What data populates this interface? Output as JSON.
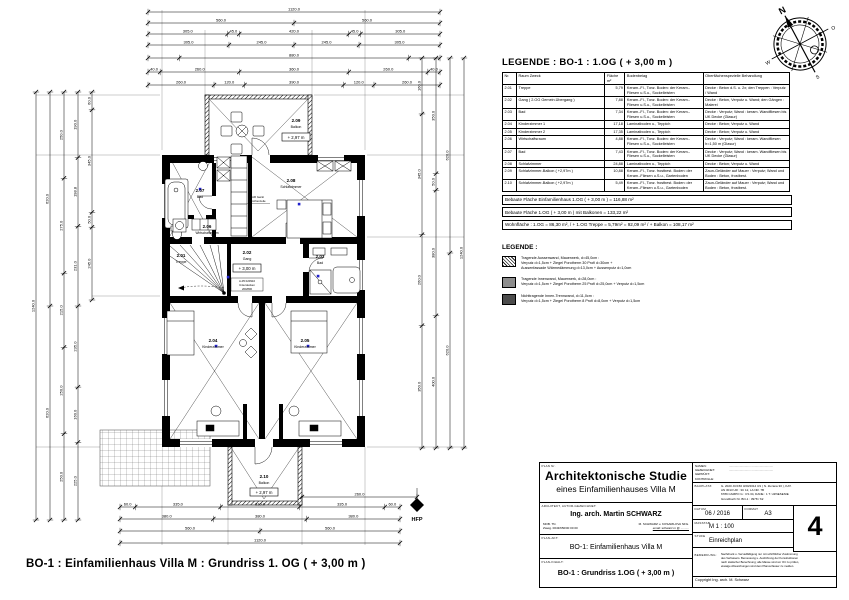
{
  "plan": {
    "caption": "BO-1 : Einfamilienhaus Villa M : Grundriss 1. OG ( + 3,00 m )",
    "hfp": "HFP",
    "levels": {
      "og": "+ 3,00 m",
      "balkon_top": "+ 2,97 m",
      "balkon_bottom": "+ 2,97 m"
    },
    "note_gang": [
      "A-05 020910",
      "Unterdecken",
      "200/800"
    ],
    "note_schlaf1": "AR Gerät",
    "note_schlaf2": "Küchenzeile",
    "rooms": [
      {
        "nr": "2.01",
        "name": "Treppe"
      },
      {
        "nr": "2.02",
        "name": "Gang"
      },
      {
        "nr": "2.03",
        "name": "Bad"
      },
      {
        "nr": "2.04",
        "name": "Kinderzimmer"
      },
      {
        "nr": "2.05",
        "name": "Kinderzimmer"
      },
      {
        "nr": "2.06",
        "name": "Wirtschaftsraum"
      },
      {
        "nr": "2.07",
        "name": "Bad"
      },
      {
        "nr": "2.08",
        "name": "Schlafzimmer"
      },
      {
        "nr": "2.09",
        "name": "Balkon"
      },
      {
        "nr": "2.10",
        "name": "Balkon"
      }
    ],
    "accent_blue": "#2020cc",
    "dim_chains": [
      {
        "o": "h",
        "y": 12,
        "x1": 148,
        "x2": 440,
        "segs": [
          {
            "w": 1120,
            "t": "1120.0"
          }
        ]
      },
      {
        "o": "h",
        "y": 23,
        "x1": 148,
        "x2": 440,
        "segs": [
          {
            "w": 560,
            "t": "560.0"
          },
          {
            "w": 560,
            "t": "560.0"
          }
        ]
      },
      {
        "o": "h",
        "y": 34,
        "x1": 148,
        "x2": 440,
        "segs": [
          {
            "w": 305,
            "t": "305.0"
          },
          {
            "w": 45,
            "t": "45.0"
          },
          {
            "w": 420,
            "t": "420.0"
          },
          {
            "w": 45,
            "t": "45.0"
          },
          {
            "w": 305,
            "t": "305.0"
          }
        ]
      },
      {
        "o": "h",
        "y": 45,
        "x1": 148,
        "x2": 440,
        "segs": [
          {
            "w": 305,
            "t": "305.0"
          },
          {
            "w": 245,
            "t": "245.0"
          },
          {
            "w": 245,
            "t": "245.0"
          },
          {
            "w": 305,
            "t": "305.0"
          }
        ]
      },
      {
        "o": "h",
        "y": 58,
        "x1": 148,
        "x2": 440,
        "segs": [
          {
            "w": 120,
            "t": ""
          },
          {
            "w": 880,
            "t": "880.0"
          },
          {
            "w": 120,
            "t": ""
          }
        ]
      },
      {
        "o": "h",
        "y": 72,
        "x1": 148,
        "x2": 440,
        "segs": [
          {
            "w": 40,
            "t": "40.0"
          },
          {
            "w": 260,
            "t": "260.0"
          },
          {
            "w": 360,
            "t": "360.0"
          },
          {
            "w": 260,
            "t": "260.0"
          },
          {
            "w": 40,
            "t": "40.0"
          }
        ]
      },
      {
        "o": "h",
        "y": 85,
        "x1": 148,
        "x2": 440,
        "segs": [
          {
            "w": 260,
            "t": "260.0"
          },
          {
            "w": 120,
            "t": "120.0"
          },
          {
            "w": 390,
            "t": "390.0"
          },
          {
            "w": 120,
            "t": "120.0"
          },
          {
            "w": 260,
            "t": "260.0"
          }
        ]
      },
      {
        "o": "h",
        "y": 497,
        "x1": 302,
        "x2": 417,
        "segs": [
          {
            "w": 260,
            "t": "260.0"
          }
        ]
      },
      {
        "o": "h",
        "y": 507,
        "x1": 120,
        "x2": 400,
        "segs": [
          {
            "w": 60,
            "t": "60.0"
          },
          {
            "w": 335,
            "t": "335.0"
          },
          {
            "w": 310,
            "t": "310.0"
          },
          {
            "w": 335,
            "t": "335.0"
          },
          {
            "w": 60,
            "t": "60.0"
          }
        ]
      },
      {
        "o": "h",
        "y": 519,
        "x1": 120,
        "x2": 400,
        "segs": [
          {
            "w": 380,
            "t": "380.0"
          },
          {
            "w": 380,
            "t": "380.0"
          },
          {
            "w": 380,
            "t": "380.0"
          }
        ]
      },
      {
        "o": "h",
        "y": 531,
        "x1": 120,
        "x2": 400,
        "segs": [
          {
            "w": 560,
            "t": "560.0"
          },
          {
            "w": 560,
            "t": "560.0"
          }
        ]
      },
      {
        "o": "h",
        "y": 543,
        "x1": 120,
        "x2": 400,
        "segs": [
          {
            "w": 1120,
            "t": "1120.0"
          }
        ]
      },
      {
        "o": "v",
        "x": 36,
        "y1": 92,
        "y2": 520,
        "segs": [
          {
            "w": 1240,
            "t": "1240.0"
          }
        ]
      },
      {
        "o": "v",
        "x": 50,
        "y1": 92,
        "y2": 520,
        "segs": [
          {
            "w": 620,
            "t": "620.0"
          },
          {
            "w": 620,
            "t": "620.0"
          }
        ]
      },
      {
        "o": "v",
        "x": 64,
        "y1": 92,
        "y2": 520,
        "segs": [
          {
            "w": 250,
            "t": "250.0"
          },
          {
            "w": 275,
            "t": "275.0"
          },
          {
            "w": 215,
            "t": "215.0"
          },
          {
            "w": 250,
            "t": "250.0"
          },
          {
            "w": 250,
            "t": "250.0"
          }
        ]
      },
      {
        "o": "v",
        "x": 78,
        "y1": 92,
        "y2": 520,
        "segs": [
          {
            "w": 190,
            "t": "190.0"
          },
          {
            "w": 199,
            "t": "198.8"
          },
          {
            "w": 231,
            "t": "231.0"
          },
          {
            "w": 235,
            "t": "235.0"
          },
          {
            "w": 160,
            "t": "160.0"
          },
          {
            "w": 225,
            "t": "225.0"
          }
        ]
      },
      {
        "o": "v",
        "x": 92,
        "y1": 92,
        "y2": 300,
        "segs": [
          {
            "w": 60,
            "t": "60.0"
          },
          {
            "w": 345,
            "t": "345.0"
          },
          {
            "w": 50,
            "t": "50.0"
          },
          {
            "w": 245,
            "t": "245.0"
          }
        ]
      },
      {
        "o": "v",
        "x": 422,
        "y1": 58,
        "y2": 448,
        "segs": [
          {
            "w": 160,
            "t": "160.0"
          },
          {
            "w": 345,
            "t": "345.0"
          },
          {
            "w": 260,
            "t": "260.0"
          },
          {
            "w": 350,
            "t": "350.0"
          }
        ]
      },
      {
        "o": "v",
        "x": 436,
        "y1": 58,
        "y2": 448,
        "segs": [
          {
            "w": 350,
            "t": "350.0"
          },
          {
            "w": 50,
            "t": "50.0"
          },
          {
            "w": 380,
            "t": "380.0"
          },
          {
            "w": 400,
            "t": "400.0"
          }
        ]
      },
      {
        "o": "v",
        "x": 450,
        "y1": 58,
        "y2": 448,
        "segs": [
          {
            "w": 620,
            "t": "620.0"
          },
          {
            "w": 620,
            "t": "620.0"
          }
        ]
      },
      {
        "o": "v",
        "x": 464,
        "y1": 58,
        "y2": 448,
        "segs": [
          {
            "w": 1240,
            "t": "1240.0"
          }
        ]
      }
    ]
  },
  "compass": {
    "n": "N",
    "e": "O",
    "s": "S",
    "w": "W"
  },
  "legend_table": {
    "title": "LEGENDE : BO-1 : 1.OG ( + 3,00 m )",
    "headers": [
      "Nr.",
      "Raum Zweck",
      "Fläche m²",
      "Bodenbelag",
      "Oberflächenspezielle Behandlung"
    ],
    "rows": [
      {
        "nr": "2.01",
        "name": "Treppe",
        "area": "5,79",
        "floor": "Keram.-Fl., Tonz. Boden: der Keram.-Fliesen u.S.u., Sockelleisten",
        "surface": "Decke : Beton d.S. u. 2x; den Treppen : Verputz / Wand"
      },
      {
        "nr": "2.02",
        "name": "Gang ( 2.OG Gemein.Übergang )",
        "area": "7,88",
        "floor": "Keram.-Fl., Tonz. Boden: der Keram.-Fliesen u.S.u., Sockelleisten",
        "surface": "Decke : Beton, Verputz u. Wand; den Gängen : Malerei"
      },
      {
        "nr": "2.03",
        "name": "Bad",
        "area": "7,34",
        "floor": "Keram.-Fl., Tonz. Boden: der Keram.-Fliesen u.S.u., Sockelleisten",
        "surface": "Decke : Verputz; Wand : keram. Wandfliesen bis UK Decke (Glasur)"
      },
      {
        "nr": "2.04",
        "name": "Kinderzimmer 1",
        "area": "17,18",
        "floor": "Laminatboden u., Teppich",
        "surface": "Decke : Beton; Verputz u. Wand"
      },
      {
        "nr": "2.05",
        "name": "Kinderzimmer 2",
        "area": "17,35",
        "floor": "Laminatboden u., Teppich",
        "surface": "Decke : Beton; Verputz u. Wand"
      },
      {
        "nr": "2.06",
        "name": "Wirtschaftsraum",
        "area": "4,88",
        "floor": "Keram.-Fl., Tonz. Boden: der Keram.-Fliesen u.S.u., Sockelleisten",
        "surface": "Decke : Verputz; Wand : keram. Wandfliesen h=1,50 m (Glasur)"
      },
      {
        "nr": "2.07",
        "name": "Bad",
        "area": "7,43",
        "floor": "Keram.-Fl., Tonz. Boden: der Keram.-Fliesen u.S.u., Sockelleisten",
        "surface": "Decke : Verputz; Wand : keram. Wandfliesen bis UK Decke (Glasur)"
      },
      {
        "nr": "2.08",
        "name": "Schlafzimmer",
        "area": "24,88",
        "floor": "Laminatboden u., Teppich",
        "surface": "Decke : Beton; Verputz u. Wand"
      },
      {
        "nr": "2.09",
        "name": "Schlafzimmer-Balkon ( +2,97m )",
        "area": "10,88",
        "floor": "Keram.-Fl., Tonz. frostbest. Boden: der Keram.-Fliesen u.S.u., Gartenboden",
        "surface": "Zaun-Geländer auf Mauer : Verputz; Wand und Boden : Beton, frostbest."
      },
      {
        "nr": "2.10",
        "name": "Schlafzimmer-Balkon ( +2,97m )",
        "area": "5,49",
        "floor": "Keram.-Fl., Tonz. frostbest. Boden: der Keram.-Fliesen u.S.u., Gartenboden",
        "surface": "Zaun-Geländer auf Mauer : Verputz; Wand und Boden : Beton, frostbest."
      }
    ],
    "summary": [
      "Bebaute Fläche Einfamilienhaus 1.OG ( + 3,00 m ) = 116,88 m²",
      "Bebaute Fläche 1.OG ( + 3,00 m ) mit Balkonen = 133,22 m²",
      "Wohnfläche : 1.OG = 86,30 m², / + 1.OG Treppe = 5,79m² = 92,09 m² / + Balkon = 108,17 m²"
    ]
  },
  "hatch_legend": {
    "title": "LEGENDE :",
    "items": [
      {
        "lines": [
          "Tragende Aussenwand, Mauerwerk, d=45,0cm :",
          "Verputz d=1,5cm + Ziegel Porotherm 30 Profi d=30cm +",
          "Aussenfassade Wärmedämmung d=13,0cm + Aussenputz d=1,0cm"
        ]
      },
      {
        "lines": [
          "Tragende Innenwand, Mauerwerk, d=28,0cm :",
          "Verputz d=1,5cm + Ziegel Porotherm 25 Profi d=25,0cm + Verputz d=1,5cm"
        ]
      },
      {
        "lines": [
          "Nichttragende Innen-Trennwand, d=11,0cm :",
          "Verputz d=1,5cm + Ziegel Porotherm 8 Profi d=8,0cm + Verputz d=1,5cm"
        ]
      }
    ]
  },
  "titleblock": {
    "title1": "Architektonische Studie",
    "title2": "eines Einfamilienhauses Villa M",
    "architect_label": "ARCHITEKT, AUTOR-GEZEICHNET:",
    "architect": "Ing. arch. Martin SCHWARZ",
    "contact_left1": "MOB. TN.",
    "contact_left2": "Zweig. 0043/650/00 00 00",
    "contact_right1": "M. SCHWARZ u. KOSARILOVA NFG.",
    "contact_right2": "email: schwarz.m @ ..........",
    "project_label": "PLAN-AKT:",
    "project": "BO-1: Einfamilienhaus Villa M",
    "drawing_label": "PLAN-INHALT:",
    "drawing": "BO-1 : Grundriss 1.OG ( + 3,00 m )",
    "names_labels": [
      "NAMEN:",
      "GEZEICHNET:",
      "GEPRÜFT:",
      "KONTROLLE:"
    ],
    "names_dots": [
      ".......................... ..........................",
      ".......................... .........................."
    ],
    "bauplatz_label": "BAUPLATZ:",
    "bauplatz_lines": [
      "G. 2020 JC/150 3/20/2014 3/1 ( N. Zuzana 30 ), KAT.",
      "AN 3013 UR : 3C 12, LA NR. 7B",
      "6789 CAMPO G : CS 34, DANE : 1 T. UZNESENIE",
      "Grundbuch Nr. BO-1 : 3978 / 62"
    ],
    "datum_label": "DATUM",
    "datum": "06 / 2016",
    "format_label": "FORMAT",
    "format": "A3",
    "plannr_label": "PLAN Nr.",
    "masstab_label": "MASSTAB",
    "masstab": "M 1 : 100",
    "stufe_label": "STUFE",
    "stufe": "Einreichplan",
    "sheet_no": "4",
    "bemerkung_label": "BEMERKUNG:",
    "bemerkung_lines": [
      "Nachdruck u. Vervielfältigung nur mit schriftlicher Zustimmung",
      "des Verfassers. Bemessung u. Ausführung der Konstruktionen",
      "nach statischer Berechnung; alle Masse sind vor Ort zu prüfen,",
      "etwaige Abweichungen sind dem Planverfasser zu melden."
    ],
    "copyright": "Copyright Ing. arch. M. Schwarz"
  }
}
